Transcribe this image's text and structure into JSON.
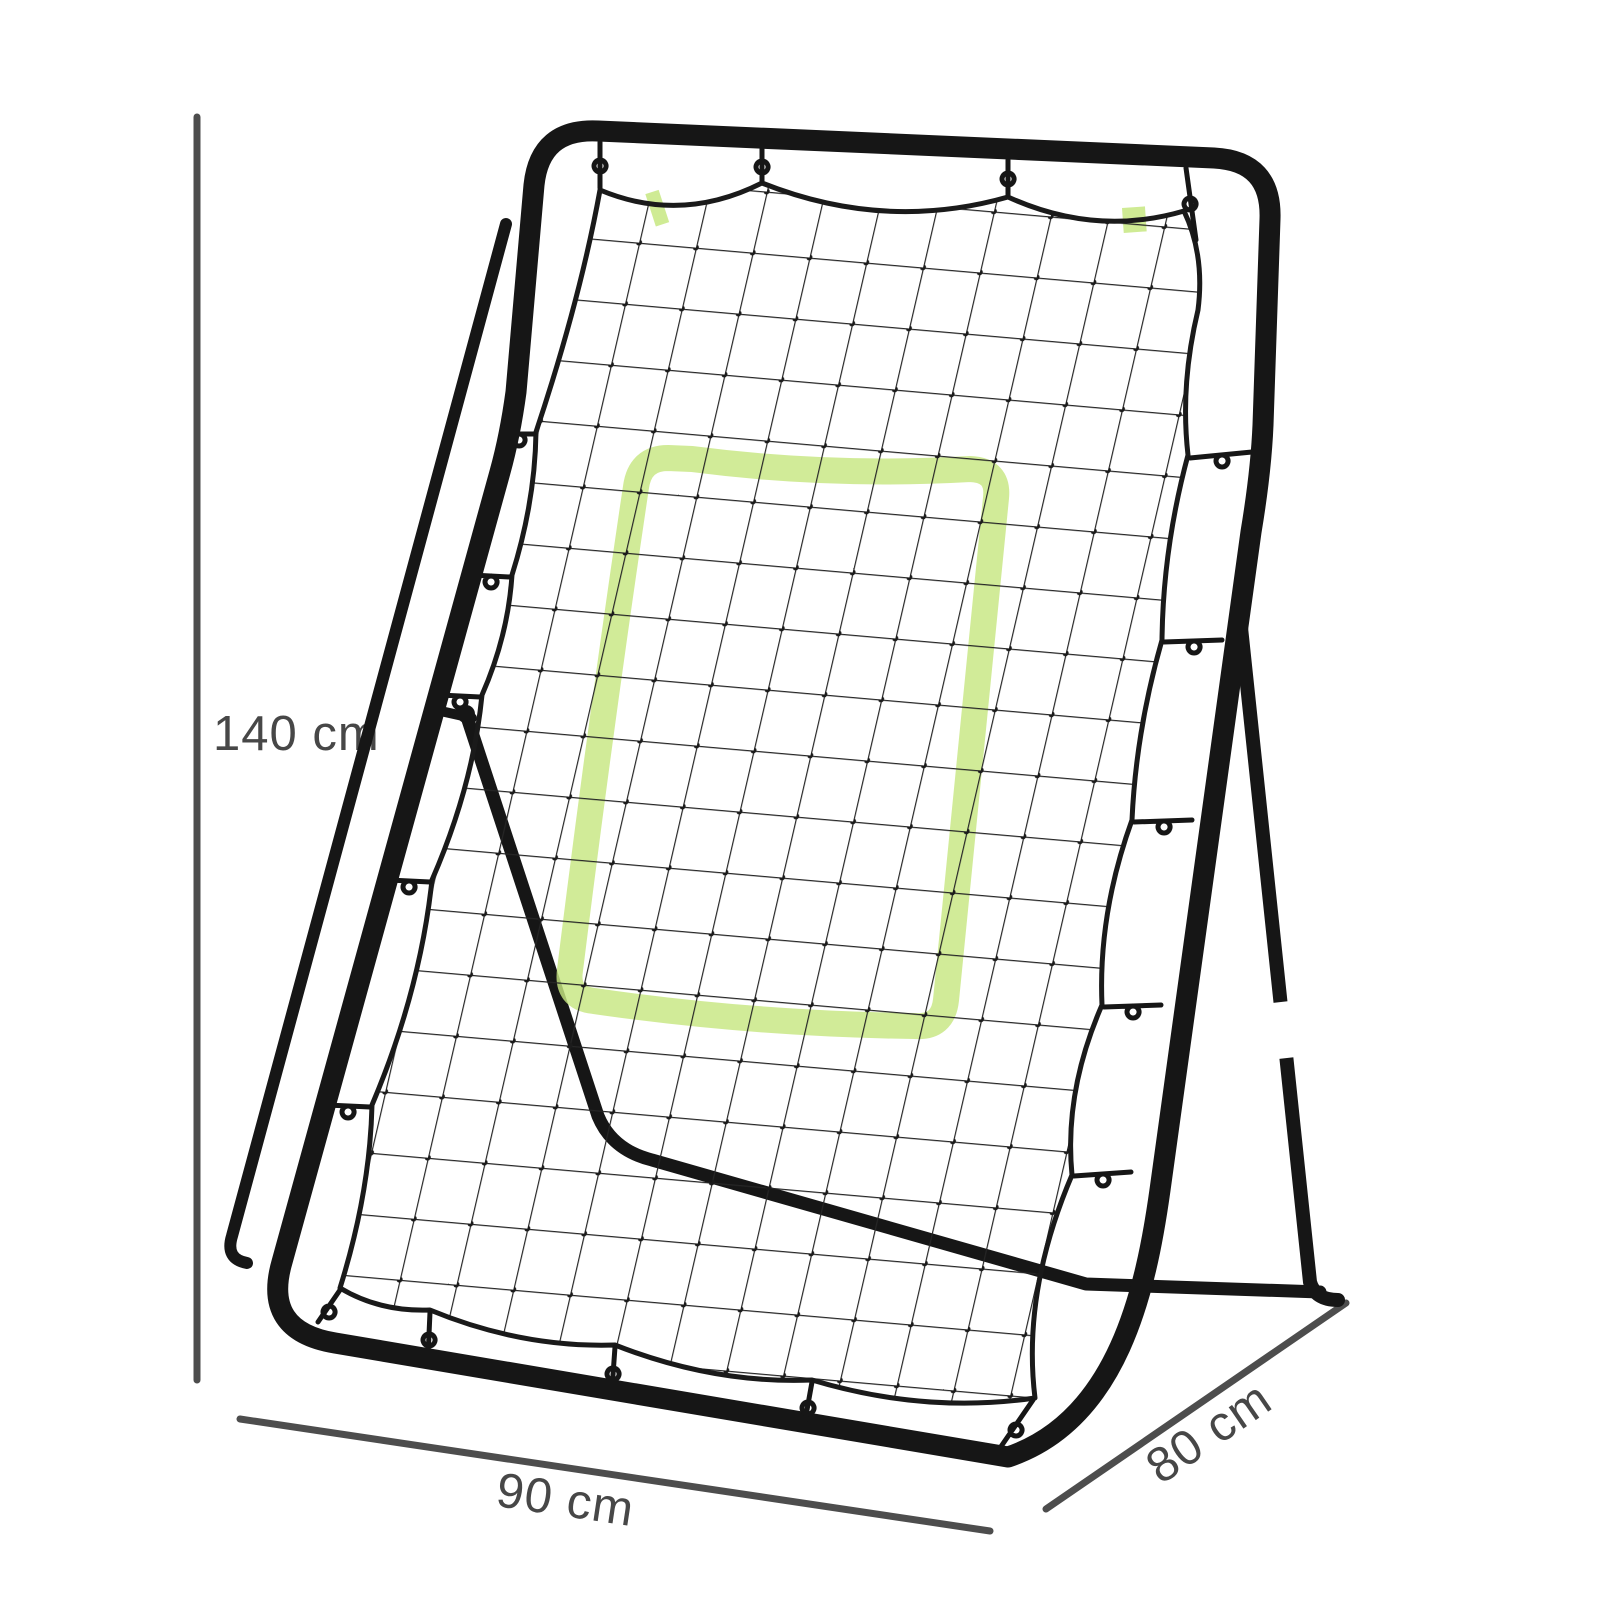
{
  "page": {
    "background_color": "#ffffff"
  },
  "diagram": {
    "dimensions": {
      "height": {
        "label": "140 cm"
      },
      "width": {
        "label": "90 cm"
      },
      "depth": {
        "label": "80 cm"
      }
    },
    "colors": {
      "frame": "#161616",
      "net_mesh": "#262626",
      "net_edge": "#1a1a1a",
      "target_zone": "#c7e781",
      "dimension_line": "#4d4d4d",
      "label_text": "#474747",
      "adjustment_band": "#ffffff",
      "background": "#ffffff"
    }
  }
}
